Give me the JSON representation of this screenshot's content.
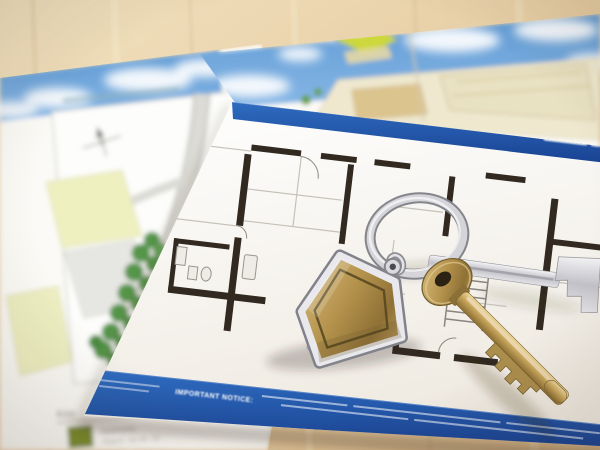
{
  "scene": {
    "objects": [
      "site-plan-brochure",
      "development-brochure",
      "floor-plan-sheet",
      "split-ring",
      "house-keyring-fob",
      "brass-key",
      "chrome-key",
      "wooden-table"
    ]
  },
  "colors": {
    "table_wood": "#e6cda4",
    "sky_blue": "#5f9ad4",
    "banner_blue": "#1d55a8",
    "plan_wall": "#322a21",
    "tree_green": "#55964a",
    "plot_yellow_green": "#eef0c0",
    "legend_swatch_green": "#7c8d2f",
    "key_brass": "#b3945a",
    "keyring_chrome": "#d8d8dc",
    "paper_white": "#fbfaf6"
  },
  "site_plan_sheet": {
    "legend_title": "Key",
    "legend_items": [
      {
        "label": "Apartments",
        "detail": "Plots 9 - 13, 20 - 24"
      }
    ]
  },
  "floor_plan_sheet": {
    "caption": "Ground Floor",
    "notice_label": "IMPORTANT NOTICE:"
  }
}
